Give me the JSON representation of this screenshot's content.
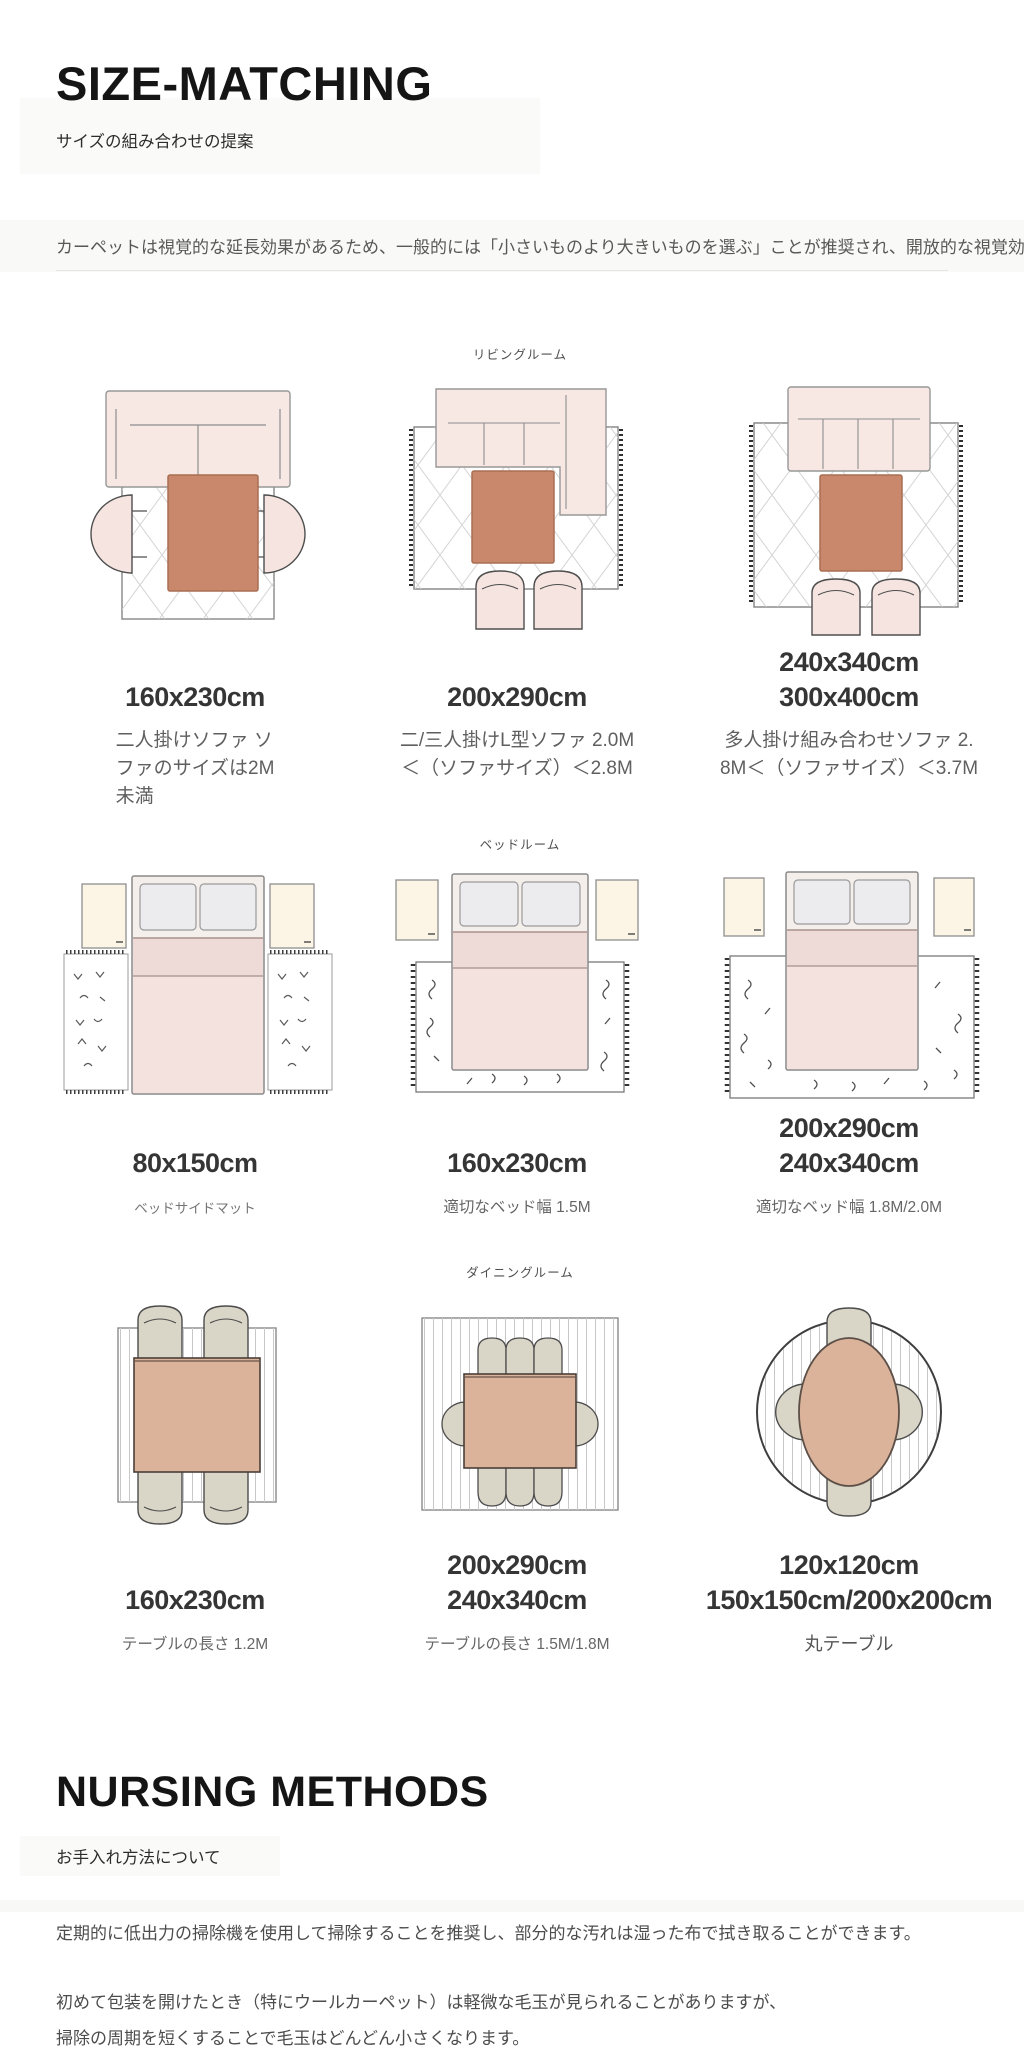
{
  "header": {
    "title": "SIZE-MATCHING",
    "subtitle": "サイズの組み合わせの提案",
    "intro": "カーペットは視覚的な延長効果があるため、一般的には「小さいものより大きいものを選ぶ」ことが推奨され、開放的な視覚効果が得られます。"
  },
  "rooms": [
    {
      "name": "リビングルーム",
      "items": [
        {
          "sizes": [
            "160x230cm"
          ],
          "desc": [
            "二人掛けソファ ソ",
            "ファのサイズは2M",
            "未満"
          ]
        },
        {
          "sizes": [
            "200x290cm"
          ],
          "desc": [
            "二/三人掛けL型ソファ 2.0M",
            "＜（ソファサイズ）＜2.8M"
          ]
        },
        {
          "sizes": [
            "240x340cm",
            "300x400cm"
          ],
          "desc": [
            "多人掛け組み合わせソファ 2.",
            "8M＜（ソファサイズ）＜3.7M"
          ]
        }
      ]
    },
    {
      "name": "ベッドルーム",
      "items": [
        {
          "sizes": [
            "80x150cm"
          ],
          "desc": [
            "ベッドサイドマット"
          ]
        },
        {
          "sizes": [
            "160x230cm"
          ],
          "desc": [
            "適切なベッド幅 1.5M"
          ]
        },
        {
          "sizes": [
            "200x290cm",
            "240x340cm"
          ],
          "desc": [
            "適切なベッド幅 1.8M/2.0M"
          ]
        }
      ]
    },
    {
      "name": "ダイニングルーム",
      "items": [
        {
          "sizes": [
            "160x230cm"
          ],
          "desc": [
            "テーブルの長さ 1.2M"
          ]
        },
        {
          "sizes": [
            "200x290cm",
            "240x340cm"
          ],
          "desc": [
            "テーブルの長さ 1.5M/1.8M"
          ]
        },
        {
          "sizes": [
            "120x120cm",
            "150x150cm/200x200cm"
          ],
          "desc": [
            "丸テーブル"
          ]
        }
      ]
    }
  ],
  "care": {
    "title": "NURSING METHODS",
    "subtitle": "お手入れ方法について",
    "paragraphs": [
      "定期的に低出力の掃除機を使用して掃除することを推奨し、部分的な汚れは湿った布で拭き取ることができます。",
      "初めて包装を開けたとき（特にウールカーペット）は軽微な毛玉が見られることがありますが、",
      "掃除の周期を短くすることで毛玉はどんどん小さくなります。"
    ]
  },
  "colors": {
    "coffee_table_terracotta": "#c9886b",
    "sofa_pink": "#f7e8e4",
    "dining_table_tan": "#dbb29a",
    "dining_chair_gray": "#d9d5c7",
    "size_label_text": "#353535",
    "muted_text": "#5f5f5f"
  }
}
